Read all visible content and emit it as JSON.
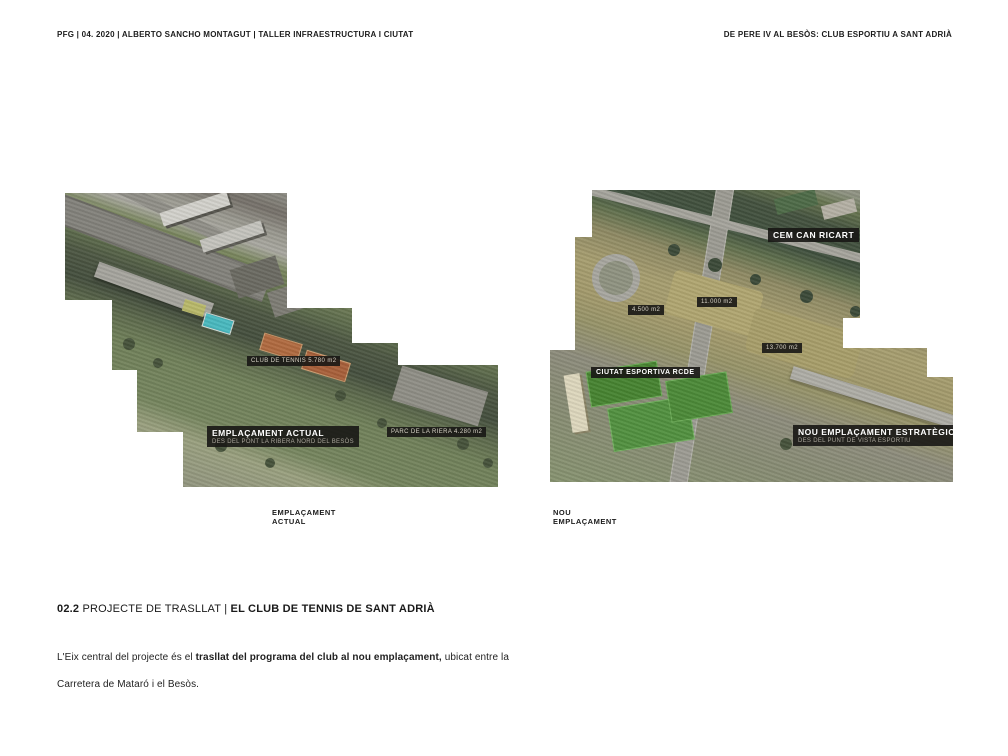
{
  "header": {
    "left": "PFG | 04. 2020 | ALBERTO SANCHO MONTAGUT | TALLER INFRAESTRUCTURA I CIUTAT",
    "right": "DE PERE IV AL BESÒS: CLUB ESPORTIU A SANT ADRIÀ"
  },
  "figures": {
    "left": {
      "caption_line1": "EMPLAÇAMENT",
      "caption_line2": "ACTUAL",
      "labels": {
        "club": "CLUB DE TENNIS 5.780 m2",
        "parc": "PARC DE LA RIERA 4.280 m2",
        "main_title": "EMPLAÇAMENT ACTUAL",
        "main_subtitle": "DES DEL PONT LA RIBERA NORD DEL BESÒS"
      }
    },
    "right": {
      "caption_line1": "NOU",
      "caption_line2": "EMPLAÇAMENT",
      "labels": {
        "cem": "CEM CAN RICART",
        "area_small": "4.500 m2",
        "area_mid": "11.000 m2",
        "area_large": "13.700 m2",
        "rcde": "CIUTAT ESPORTIVA RCDE",
        "main_title": "NOU EMPLAÇAMENT ESTRATÈGIC",
        "main_subtitle": "DES DEL PUNT DE VISTA ESPORTIU"
      }
    }
  },
  "section": {
    "number": "02.2 ",
    "title_regular": "PROJECTE DE TRASLLAT ",
    "separator": "| ",
    "title_bold": "EL CLUB DE TENNIS DE SANT ADRIÀ"
  },
  "body": {
    "part1": "L'Eix central del projecte és el ",
    "part2": "trasllat del programa del club al nou emplaçament,",
    "part3": " ubicat entre la Carretera de Mataró i el Besòs."
  },
  "colors": {
    "label_background": "#181715",
    "pool_cyan": "#49b9bf",
    "clay_orange": "#b06a40",
    "pitch_green": "#4c8a38",
    "river_green": "#44523f",
    "text": "#1a1a1a"
  }
}
